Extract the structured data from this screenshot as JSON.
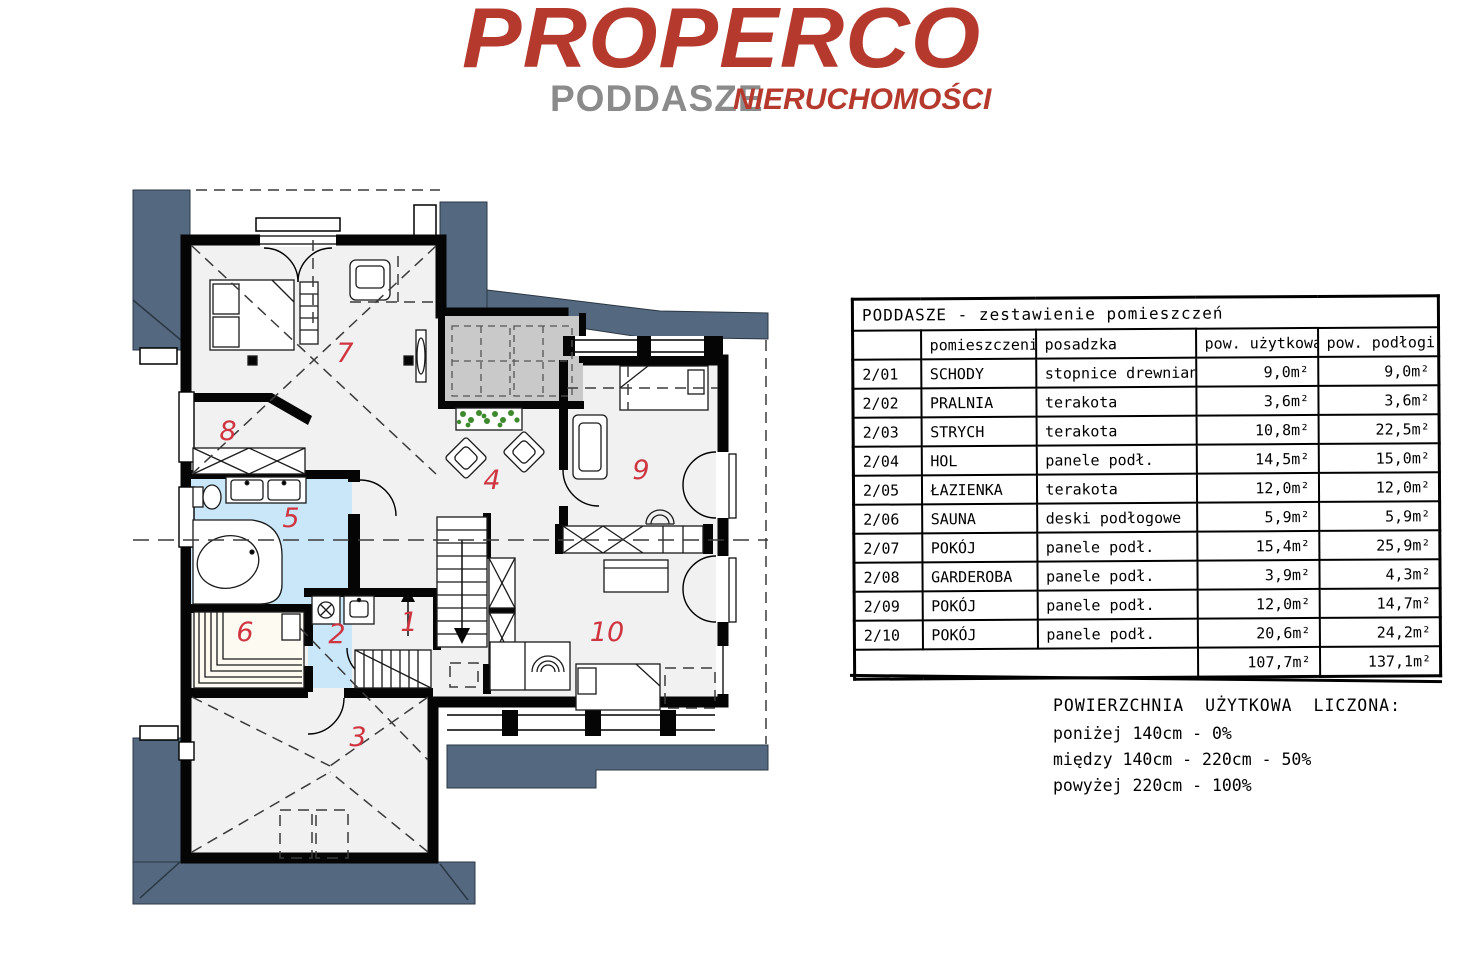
{
  "logo": {
    "brand": "PROPERCO",
    "floor_label": "PODDASZE",
    "subbrand": "NIERUCHOMOŚCI"
  },
  "plan": {
    "labels": [
      "1",
      "2",
      "3",
      "4",
      "5",
      "6",
      "7",
      "8",
      "9",
      "10"
    ]
  },
  "table": {
    "title": "PODDASZE  -  zestawienie pomieszczeń",
    "columns": [
      "",
      "pomieszczenie",
      "posadzka",
      "pow. użytkowa",
      "pow. podłogi"
    ],
    "rows": [
      {
        "id": "2/01",
        "name": "SCHODY",
        "floor": "stopnice drewniane",
        "usable": "9,0m²",
        "total": "9,0m²"
      },
      {
        "id": "2/02",
        "name": "PRALNIA",
        "floor": "terakota",
        "usable": "3,6m²",
        "total": "3,6m²"
      },
      {
        "id": "2/03",
        "name": "STRYCH",
        "floor": "terakota",
        "usable": "10,8m²",
        "total": "22,5m²"
      },
      {
        "id": "2/04",
        "name": "HOL",
        "floor": "panele podł.",
        "usable": "14,5m²",
        "total": "15,0m²"
      },
      {
        "id": "2/05",
        "name": "ŁAZIENKA",
        "floor": "terakota",
        "usable": "12,0m²",
        "total": "12,0m²"
      },
      {
        "id": "2/06",
        "name": "SAUNA",
        "floor": "deski podłogowe",
        "usable": "5,9m²",
        "total": "5,9m²"
      },
      {
        "id": "2/07",
        "name": "POKÓJ",
        "floor": "panele podł.",
        "usable": "15,4m²",
        "total": "25,9m²"
      },
      {
        "id": "2/08",
        "name": "GARDEROBA",
        "floor": "panele podł.",
        "usable": "3,9m²",
        "total": "4,3m²"
      },
      {
        "id": "2/09",
        "name": "POKÓJ",
        "floor": "panele podł.",
        "usable": "12,0m²",
        "total": "14,7m²"
      },
      {
        "id": "2/10",
        "name": "POKÓJ",
        "floor": "panele podł.",
        "usable": "20,6m²",
        "total": "24,2m²"
      }
    ],
    "sum": {
      "usable": "107,7m²",
      "total": "137,1m²"
    }
  },
  "notes": {
    "title": "POWIERZCHNIA  UŻYTKOWA  LICZONA:",
    "lines": [
      "poniżej 140cm  -  0%",
      "między 140cm - 220cm   -  50%",
      "powyżej 220cm  -  100%"
    ]
  },
  "colors": {
    "brand_red": "#b5392d",
    "roof_slate": "#54687f",
    "bath_blue": "#c9e7f8",
    "label_red": "#cf3540"
  }
}
